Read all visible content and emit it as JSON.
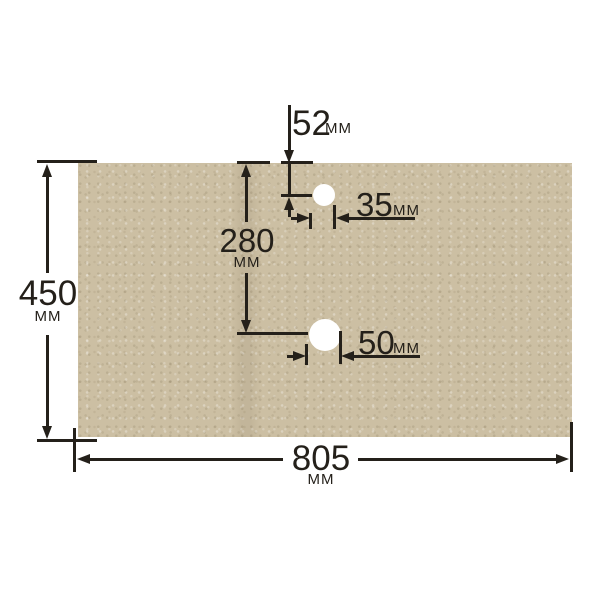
{
  "drawing": {
    "type": "panel-dimension-diagram",
    "unit": "мм",
    "colors": {
      "panel_surface": "#ccbfa3",
      "line": "#24201a",
      "background": "#ffffff",
      "hole": "#ffffff"
    },
    "dims": {
      "height": {
        "value": "450",
        "unit": "мм"
      },
      "width": {
        "value": "805",
        "unit": "мм"
      },
      "hole1_offset": {
        "value": "52",
        "unit": "мм"
      },
      "hole2_offset": {
        "value": "280",
        "unit": "мм"
      },
      "hole1_diameter": {
        "value": "35",
        "unit": "мм"
      },
      "hole2_diameter": {
        "value": "50",
        "unit": "мм"
      }
    }
  }
}
